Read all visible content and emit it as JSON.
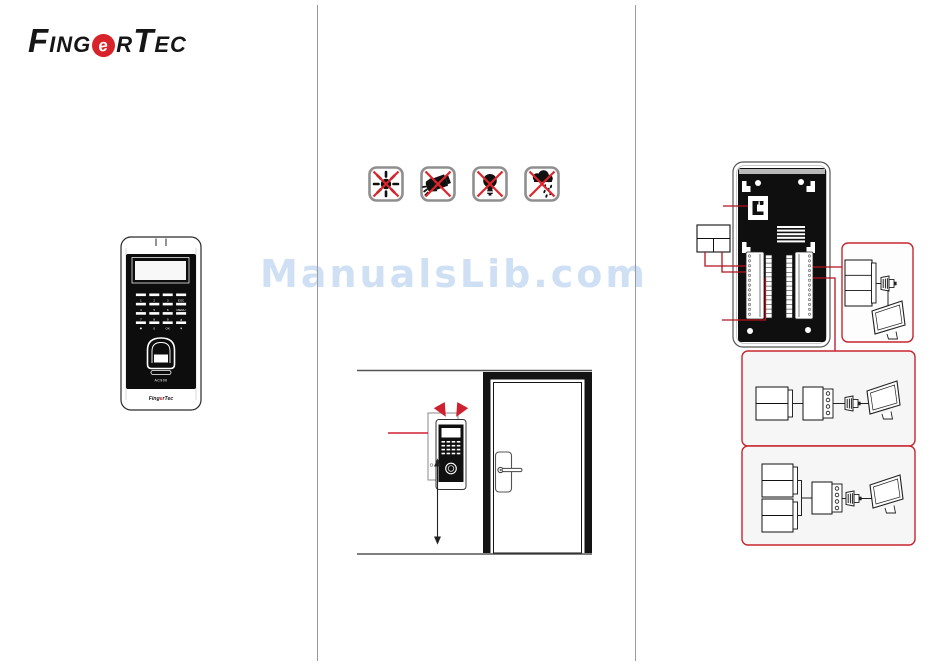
{
  "watermark": {
    "text": "ManualsLib.com",
    "color": "#cfe0f5"
  },
  "brand": {
    "name": "FingerTec",
    "logo_parts": {
      "p1": "F",
      "p2": "ING",
      "e": "e",
      "p3": "R",
      "p4": "T",
      "p5": "EC"
    },
    "mini": {
      "pre": "Fing",
      "e": "e",
      "post": "rTec"
    }
  },
  "colors": {
    "accent_red": "#cf2030",
    "box_border_red": "#c8252e",
    "divider_gray": "#9a9a9a",
    "panel_black": "#101010",
    "watermark_blue": "#cfe0f5",
    "icon_frame_gray": "#8f8f8f"
  },
  "device_front": {
    "model": "AC900",
    "keypad_rows": [
      [
        "1",
        "2",
        "3",
        "ESC"
      ],
      [
        "4",
        "5",
        "6",
        "MENU"
      ],
      [
        "7",
        "8",
        "9",
        "▲"
      ],
      [
        "✱",
        "0",
        "OK",
        "▼"
      ]
    ]
  },
  "warning_icons": [
    {
      "name": "no-direct-sunlight-icon"
    },
    {
      "name": "no-spotlight-icon"
    },
    {
      "name": "no-bulb-light-icon"
    },
    {
      "name": "no-rain-icon"
    }
  ],
  "diagrams": {
    "installation": [
      "wall-bracket",
      "mounted-device",
      "mounting-height-arrow",
      "door",
      "door-lock-handle"
    ],
    "wiring": [
      "rj45-port",
      "vent-grille",
      "terminal-block-left",
      "terminal-block-right",
      "power-supply-box",
      "connection-option-1",
      "connection-option-2",
      "connection-option-3",
      "monitor-icon",
      "db9-connector-icon"
    ]
  }
}
